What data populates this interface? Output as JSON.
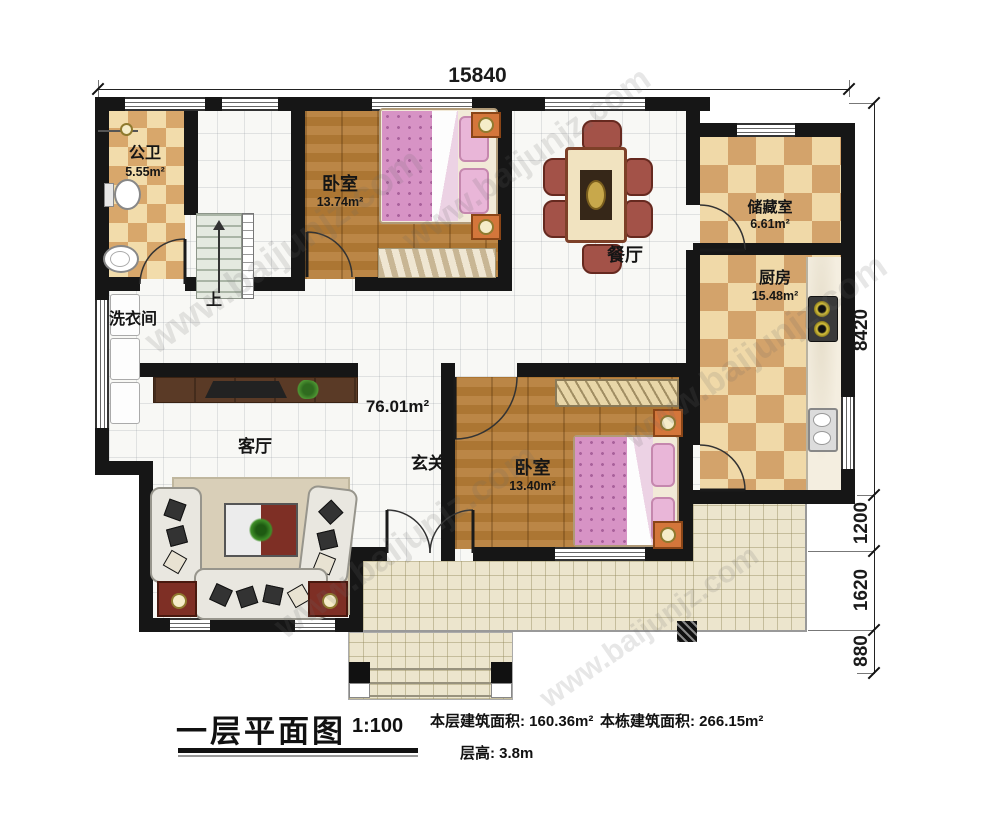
{
  "watermark": "www.baijunjz.com",
  "dimensions": {
    "top": "15840",
    "right_1": "8420",
    "right_2": "1200",
    "right_3": "1620",
    "right_4": "880"
  },
  "rooms": {
    "bathroom": {
      "label": "公卫",
      "area": "5.55m²"
    },
    "laundry": {
      "label": "洗衣间"
    },
    "stairs": {
      "label": "上"
    },
    "bedroom1": {
      "label": "卧室",
      "area": "13.74m²"
    },
    "dining": {
      "label": "餐厅"
    },
    "storage": {
      "label": "储藏室",
      "area": "6.61m²"
    },
    "kitchen": {
      "label": "厨房",
      "area": "15.48m²"
    },
    "living": {
      "label": "客厅"
    },
    "foyer": {
      "label": "玄关"
    },
    "bedroom2": {
      "label": "卧室",
      "area": "13.40m²"
    },
    "hall_area": "76.01m²"
  },
  "titleblock": {
    "title": "一层平面图",
    "scale": "1:100",
    "floor_area": "本层建筑面积: 160.36m²",
    "building_area": "本栋建筑面积: 266.15m²",
    "floor_height": "层高: 3.8m"
  },
  "colors": {
    "wall": "#161616",
    "checker_dark": "#d3a36b",
    "wood": "#b57c36",
    "terrace": "#ece5cd",
    "bed_pink": "#d793c5",
    "accent_red": "#7e2f25"
  }
}
